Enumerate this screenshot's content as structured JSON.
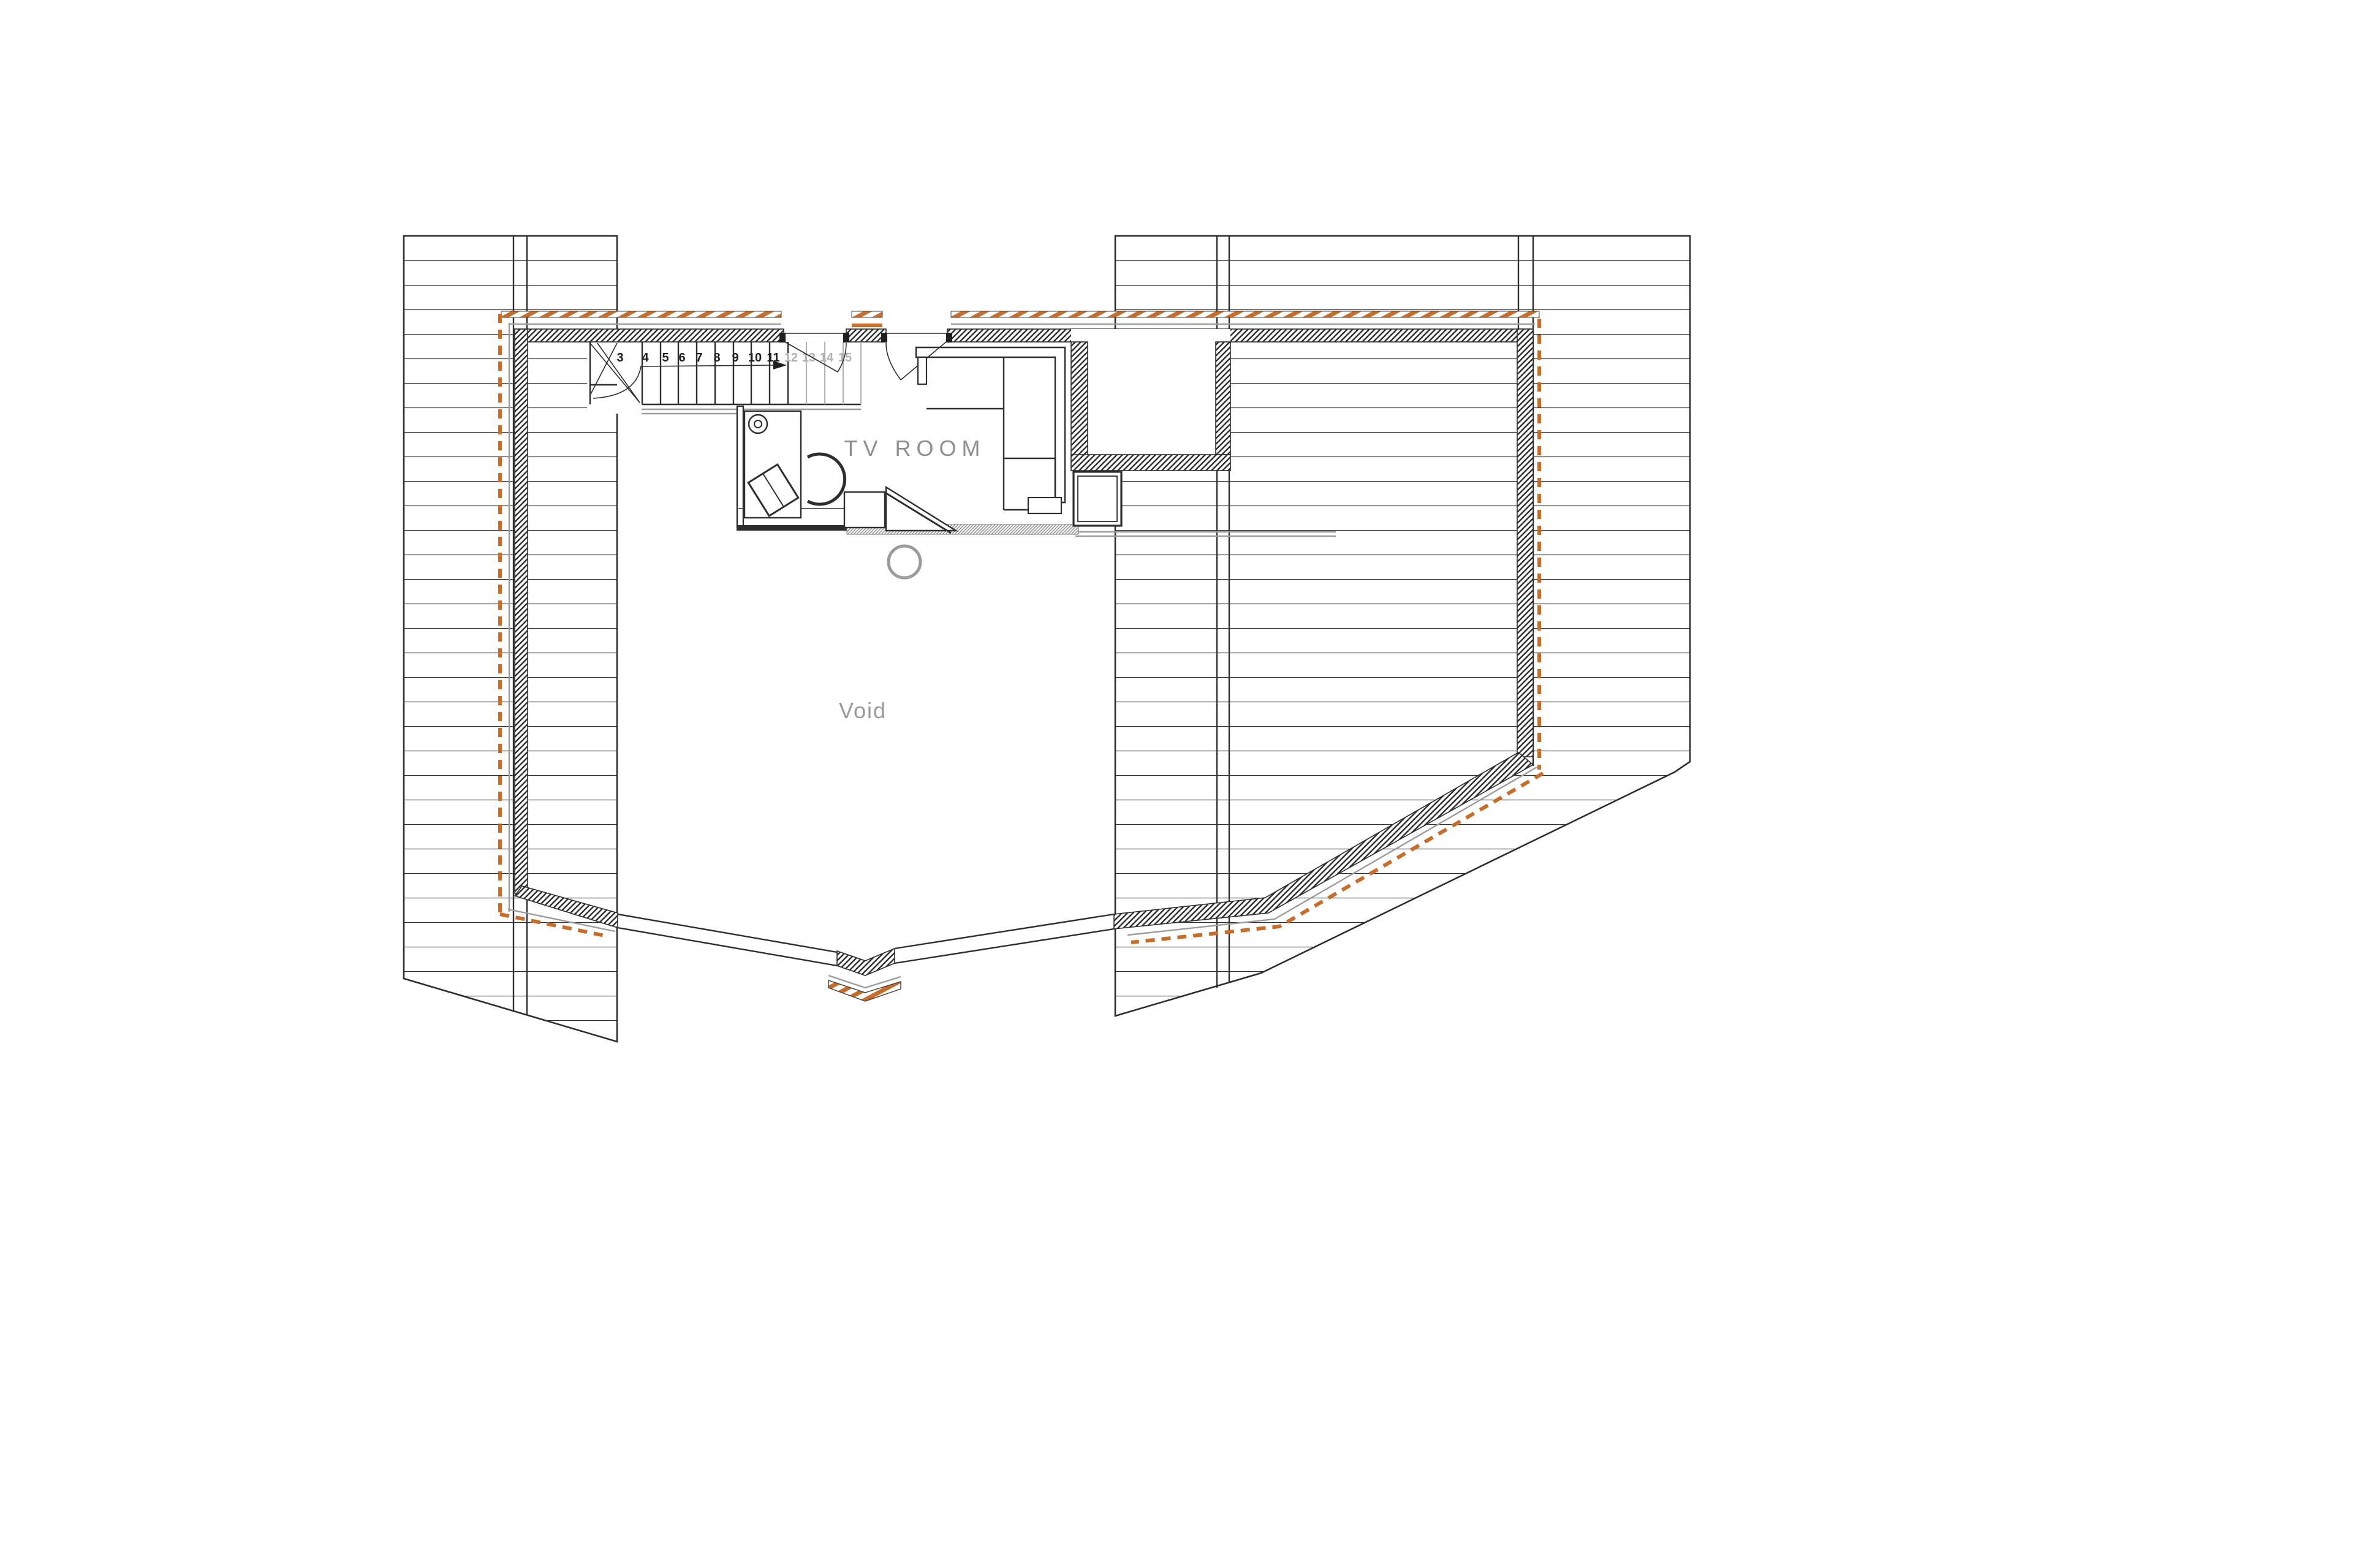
{
  "drawing": {
    "kind": "architectural floor plan — upper level (mezzanine)",
    "labels": {
      "room": "TV ROOM",
      "void": "Void"
    },
    "stair": {
      "note": "straight run with corner winder, up-direction arrow",
      "treads": [
        "3",
        "4",
        "5",
        "6",
        "7",
        "8",
        "9",
        "10",
        "11",
        "12",
        "13",
        "14",
        "15"
      ]
    },
    "colors": {
      "background": "#ffffff",
      "line": "#2e2e2e",
      "gray_line": "#9b9b9b",
      "light_gray": "#b3b3b3",
      "orange_accent": "#c96c28",
      "label_text": "#8f8f8f"
    }
  }
}
